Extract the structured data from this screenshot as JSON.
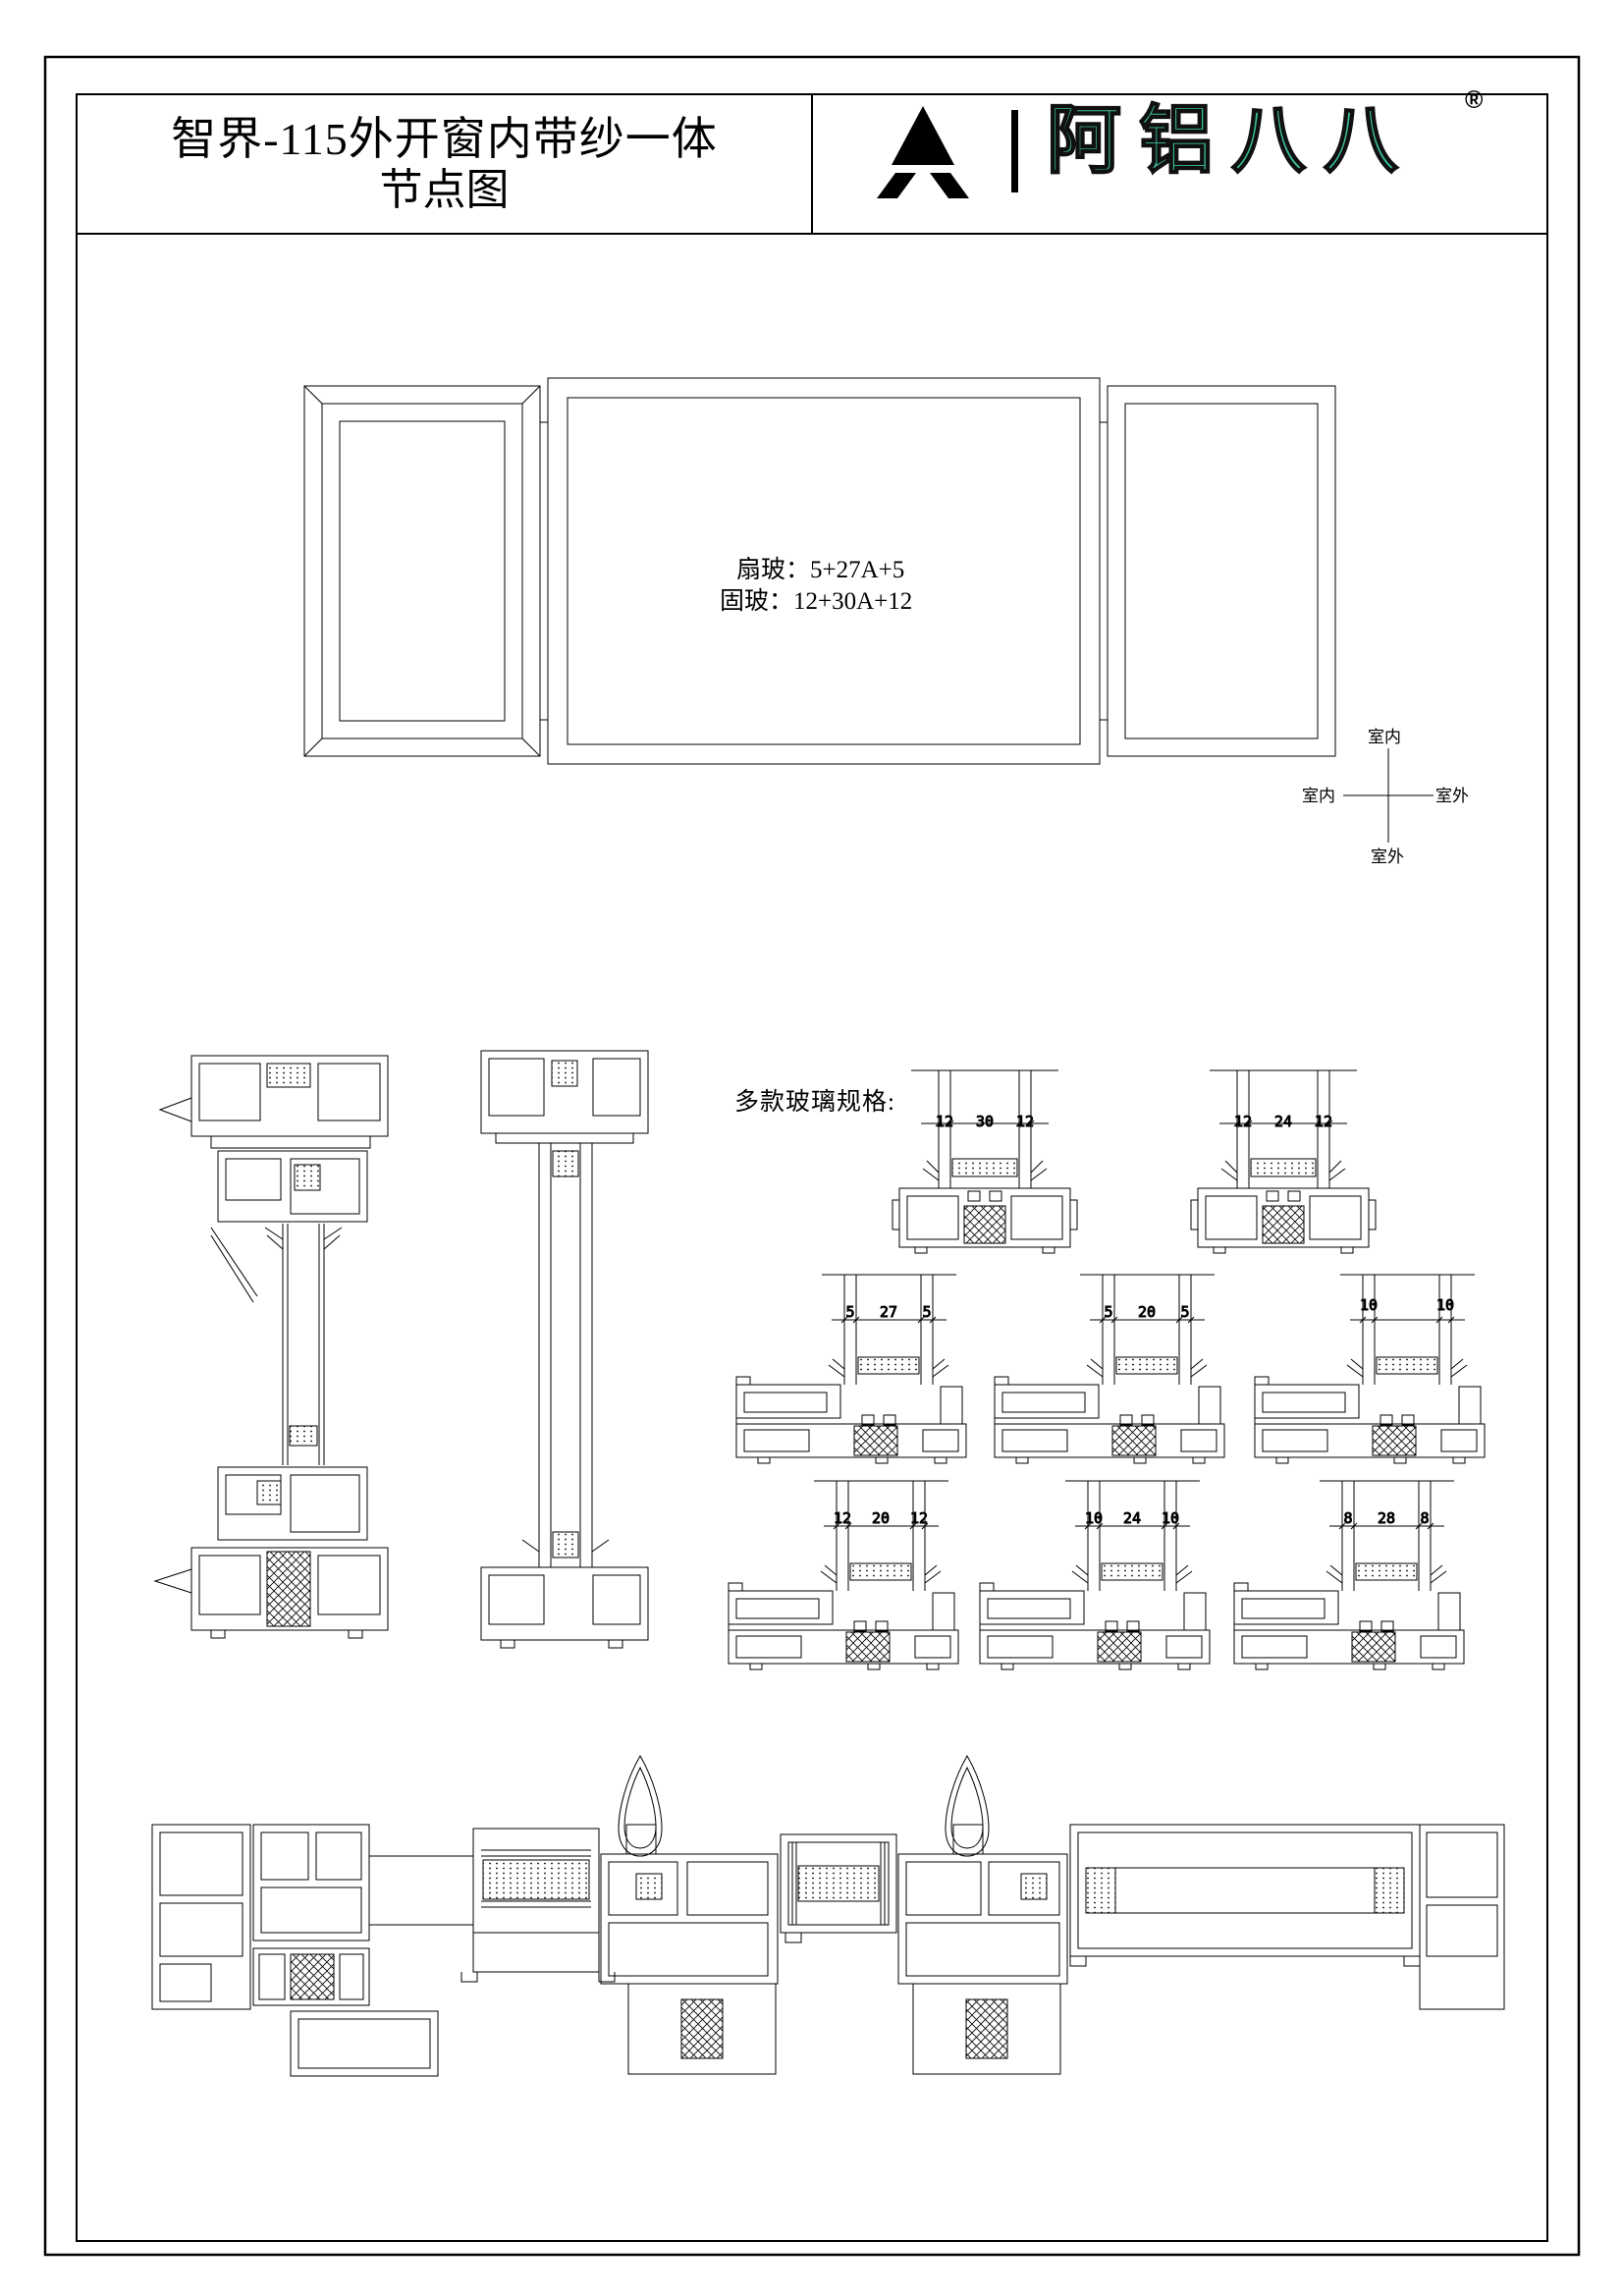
{
  "sheet": {
    "title_line1": "智界-115外开窗内带纱一体",
    "title_line2": "节点图"
  },
  "logo": {
    "mark_icon": "triangle-a-icon",
    "brand_text": "阿铝八八",
    "registered_mark": "®",
    "brand_color": "#3bbd9c"
  },
  "elevation": {
    "sash_glass_label": "扇玻：5+27A+5",
    "fixed_glass_label": "固玻：12+30A+12"
  },
  "compass": {
    "top": "室内",
    "left": "室内",
    "right": "室外",
    "bottom": "室外"
  },
  "glass_specs": {
    "heading": "多款玻璃规格:",
    "details": [
      {
        "name": "mullion-12-30-12",
        "dims": [
          "12",
          "30",
          "12"
        ]
      },
      {
        "name": "mullion-12-24-12",
        "dims": [
          "12",
          "24",
          "12"
        ]
      },
      {
        "name": "frame-5-27-5",
        "dims": [
          "5",
          "27",
          "5"
        ]
      },
      {
        "name": "frame-5-20-5",
        "dims": [
          "5",
          "20",
          "5"
        ]
      },
      {
        "name": "frame-10-10",
        "dims": [
          "10",
          "",
          "10"
        ]
      },
      {
        "name": "frame-12-20-12",
        "dims": [
          "12",
          "20",
          "12"
        ]
      },
      {
        "name": "frame-10-24-10",
        "dims": [
          "10",
          "24",
          "10"
        ]
      },
      {
        "name": "frame-8-28-8",
        "dims": [
          "8",
          "28",
          "8"
        ]
      }
    ]
  }
}
